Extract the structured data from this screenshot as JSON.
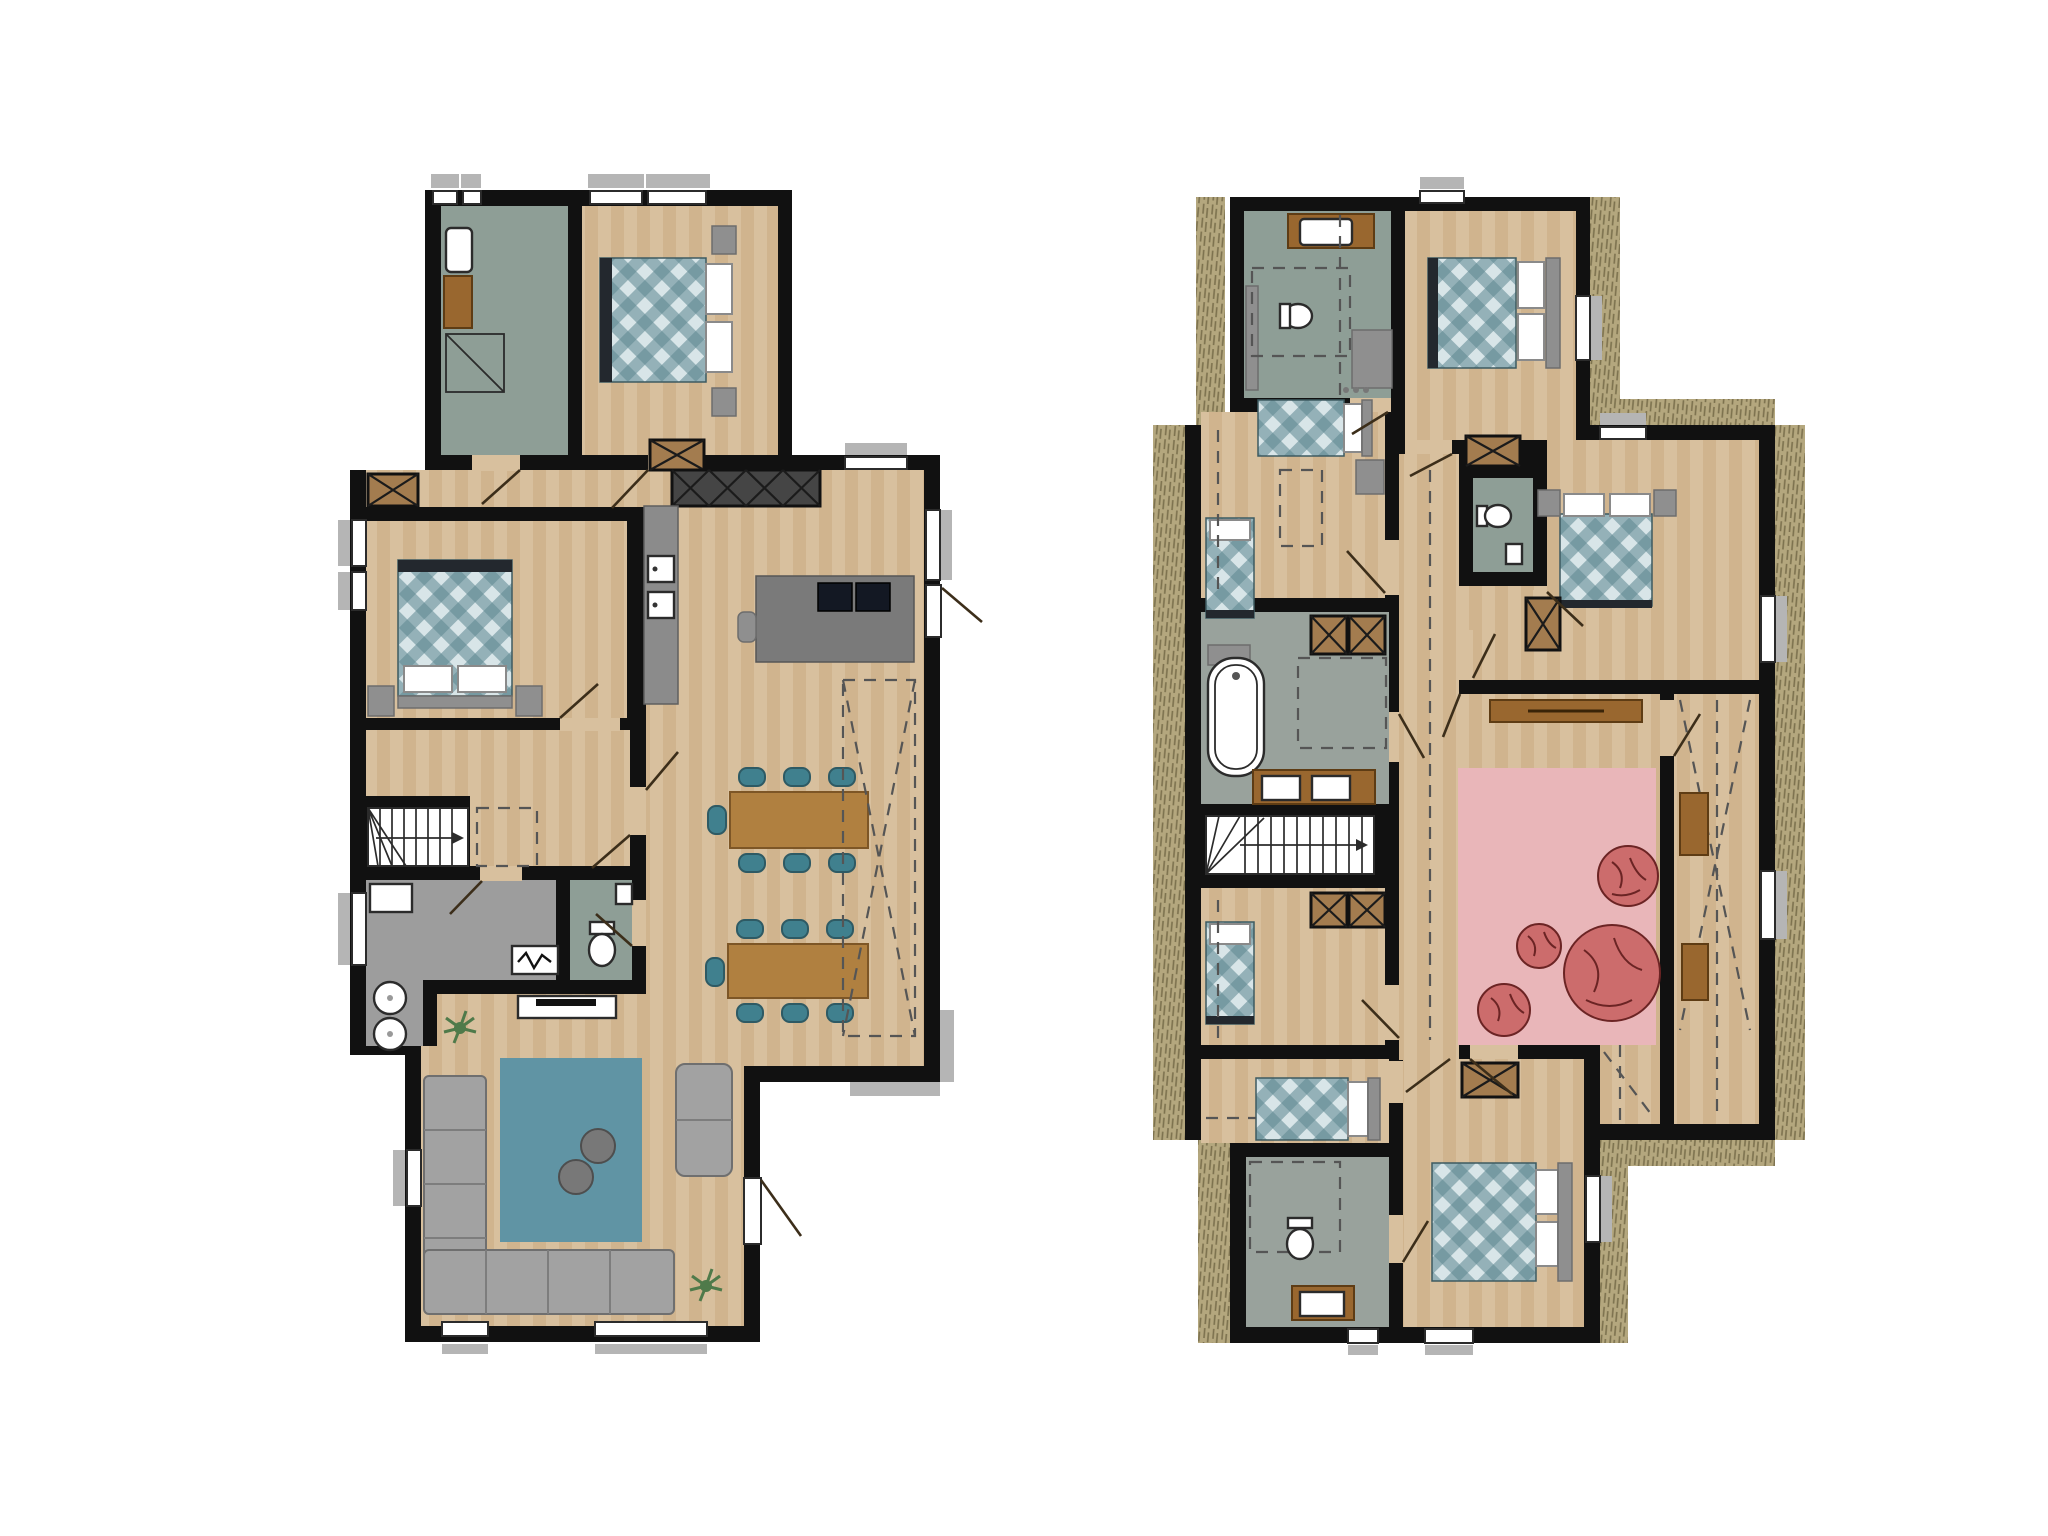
{
  "page": {
    "background": "#ffffff",
    "content_type": "architectural floor plan, two storeys side by side, no text labels"
  },
  "colors": {
    "wall": "#111111",
    "wood": "#d8c09e",
    "wood2": "#d0b48e",
    "bath_green": "#8e9e96",
    "tile_gray": "#99a29c",
    "utility_gray": "#9d9d9d",
    "counter_gray": "#8b8b8b",
    "island_gray": "#7a7a7a",
    "cabinet_dark": "#454545",
    "cooktop": "#131823",
    "wardrobe_brown": "#a37c4f",
    "table_wood": "#b08040",
    "chair_teal": "#40808e",
    "sofa_gray": "#a2a2a2",
    "rug_blue": "#6094a4",
    "pouf_gray": "#787878",
    "rug_pink": "#e9b6b9",
    "beanbag_red": "#cc6c6c",
    "beanbag_line": "#6b2424",
    "roof_hatch": "#b4a77e",
    "roof_hatch_line": "#7c714e",
    "sill_gray": "#b5b5b5",
    "line_dark": "#2b2b2b",
    "door_line": "#3c2e1a",
    "dash_gray": "#555555",
    "plant_green": "#4f7a4a",
    "sideboard_wood": "#99672f",
    "headboard_gray": "#8f8f8f",
    "bed_foot": "#23282e",
    "plaid_light": "#d8e5e8",
    "plaid_teal": "#5d868f"
  },
  "floors": [
    {
      "name": "ground-floor",
      "position": "left",
      "rooms": [
        "bathroom",
        "bedroom",
        "bedroom",
        "kitchen",
        "dining-area",
        "hall",
        "staircase",
        "utility-room",
        "wc",
        "living-room"
      ],
      "furniture_icons": [
        "shower",
        "washbasin",
        "double-bed",
        "nightstand",
        "wardrobe-cross-box",
        "tall-cabinet-row",
        "oven",
        "oven",
        "kitchen-island",
        "cooktop",
        "sink",
        "bar-stool",
        "dining-table",
        "dining-table",
        "dining-chair-x14",
        "toilet",
        "washer",
        "dryer",
        "boiler-zigzag",
        "tv-sideboard",
        "corner-sofa",
        "armchair",
        "blue-rug",
        "pouf",
        "pouf",
        "plant",
        "plant",
        "stair-arrow",
        "void-dashed-outline"
      ]
    },
    {
      "name": "upper-floor",
      "position": "right",
      "rooms": [
        "bathroom",
        "bedroom",
        "kids-bedroom",
        "bathroom-with-tub",
        "staircase",
        "bedroom",
        "bedroom",
        "ensuite-bathroom",
        "bedroom",
        "wc",
        "lounge",
        "sloped-roof-corridor"
      ],
      "furniture_icons": [
        "washbasin",
        "toilet",
        "shower-dashed",
        "double-bed",
        "single-bed",
        "single-bed",
        "wardrobe-cross-box-x6",
        "bathtub",
        "double-washbasin",
        "stair-arrow",
        "pink-rug",
        "beanbag-x4",
        "sideboard",
        "toilet",
        "toilet",
        "roof-hatch-border",
        "knee-wall-dashed-lines"
      ]
    }
  ]
}
